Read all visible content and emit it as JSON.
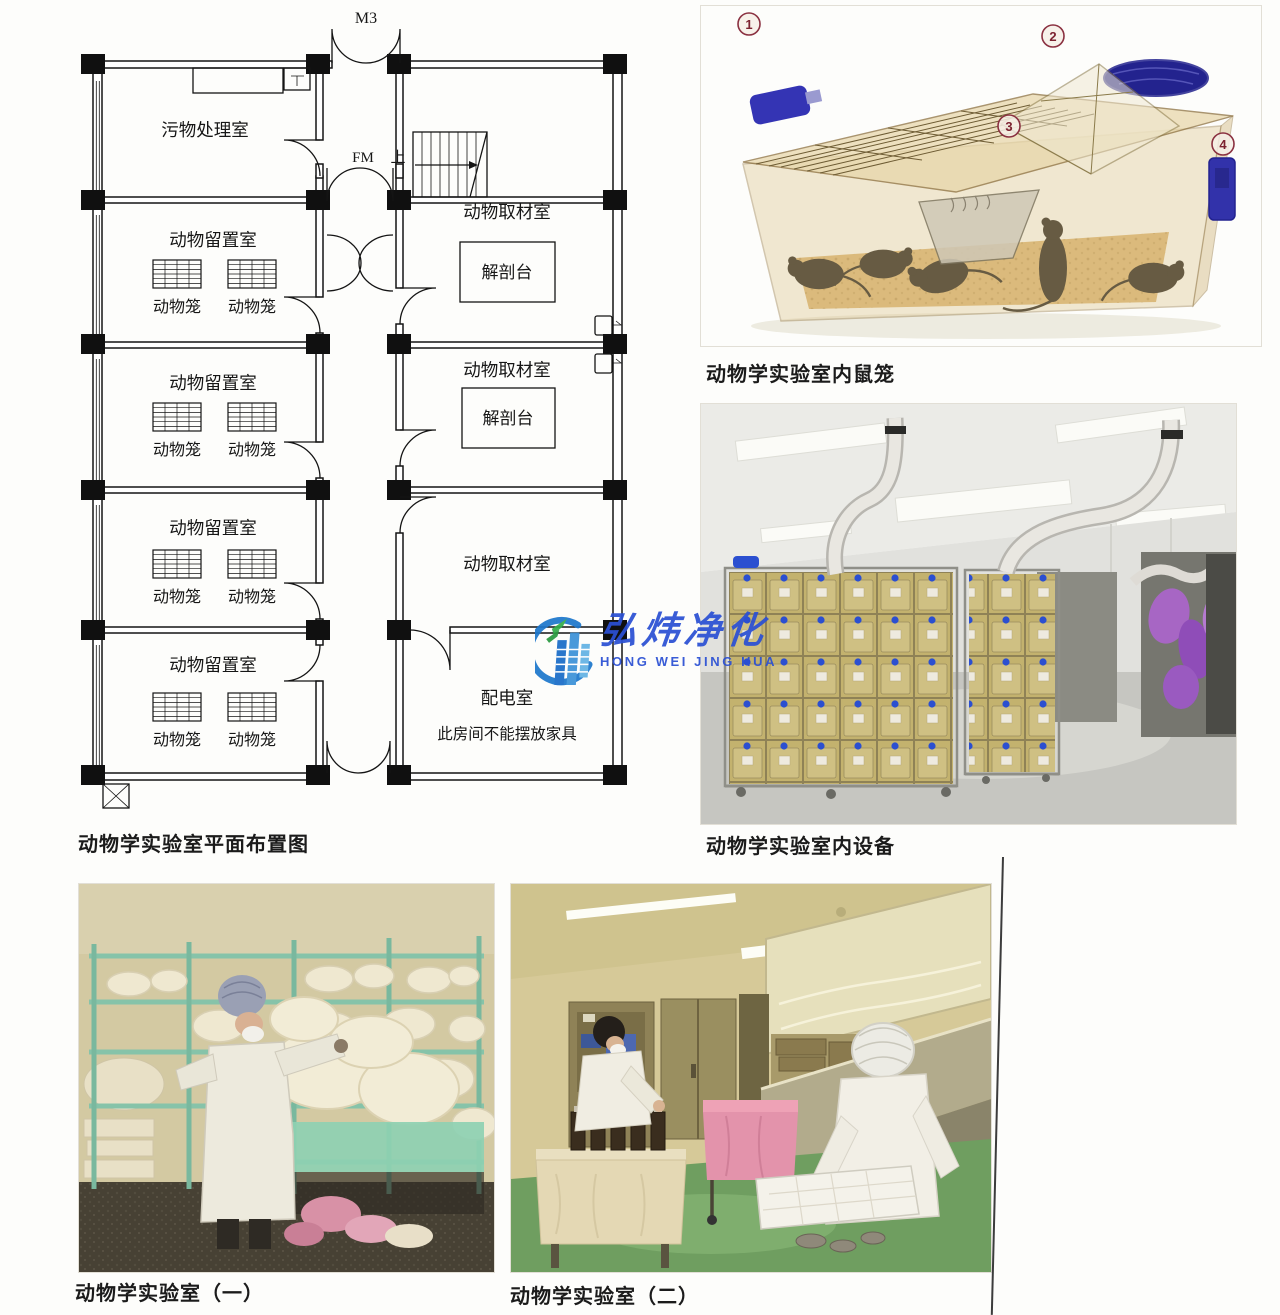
{
  "floor_plan": {
    "caption": "动物学实验室平面布置图",
    "labels": {
      "m3": "M3",
      "fm": "FM",
      "up": "上",
      "waste_room": "污物处理室",
      "holding_room": "动物留置室",
      "animal_cage": "动物笼",
      "sampling_room": "动物取材室",
      "dissection_table": "解剖台",
      "power_room": "配电室",
      "power_room_note": "此房间不能摆放家具"
    }
  },
  "figures": {
    "mouse_cage": {
      "caption": "动物学实验室内鼠笼",
      "markers": [
        "1",
        "2",
        "3",
        "4"
      ]
    },
    "equipment": {
      "caption": "动物学实验室内设备"
    },
    "lab_one": {
      "caption": "动物学实验室（一）"
    },
    "lab_two": {
      "caption": "动物学实验室（二）"
    }
  },
  "watermark": {
    "name_cn": "弘炜净化",
    "name_en": "HONG WEI JING HUA",
    "color": "#2b50d4"
  }
}
